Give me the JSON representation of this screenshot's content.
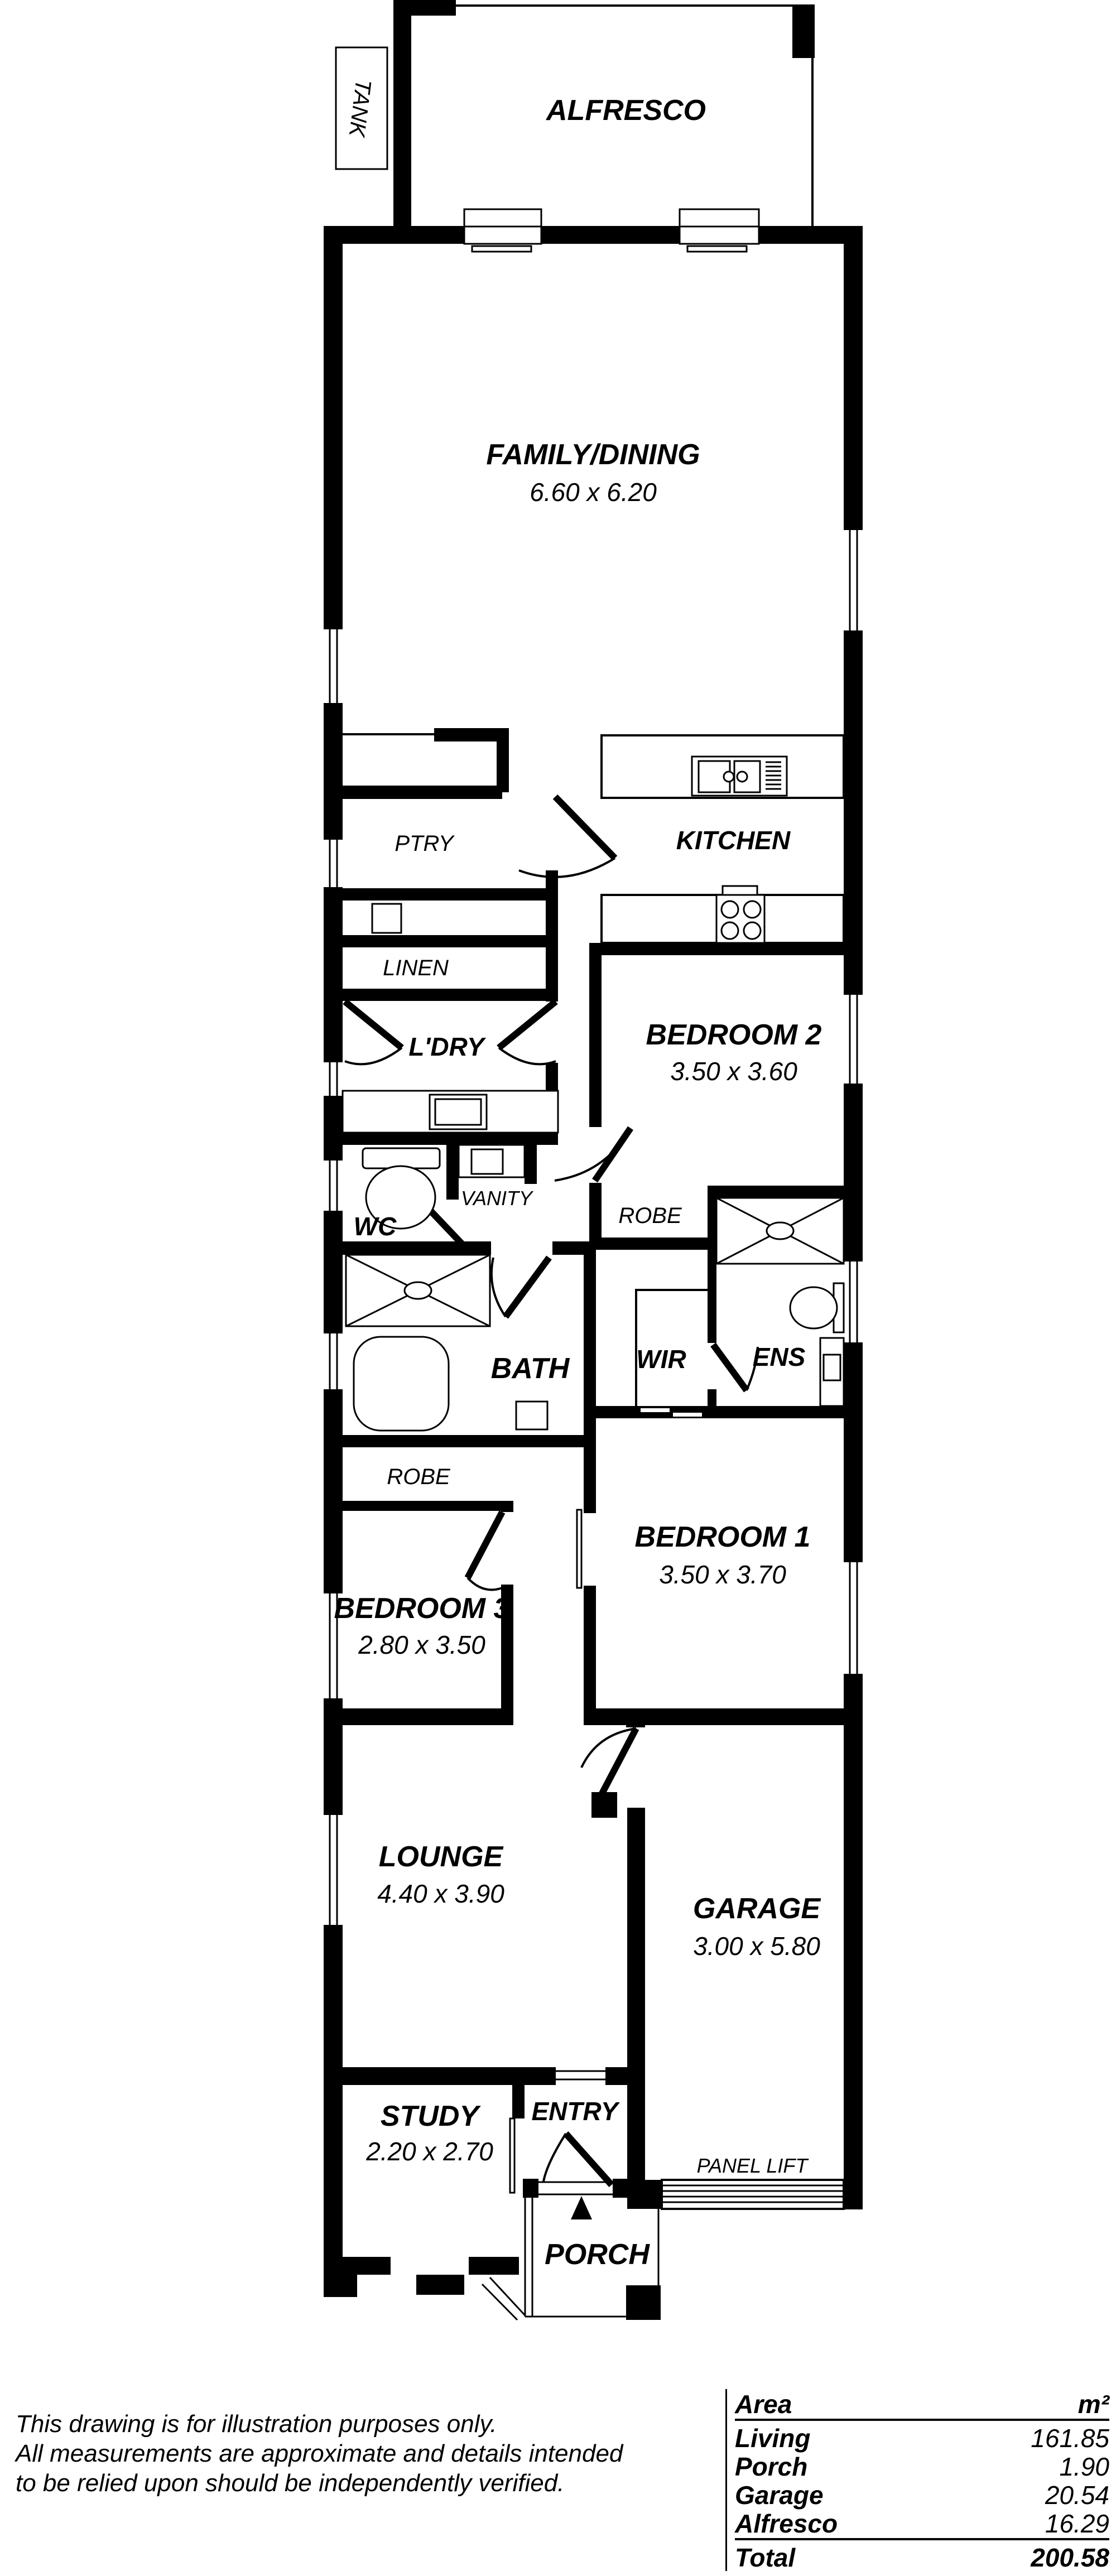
{
  "colors": {
    "wall": "#000000",
    "background": "#ffffff"
  },
  "plan": {
    "rooms": {
      "alfresco": {
        "name": "ALFRESCO"
      },
      "family": {
        "name": "FAMILY/DINING",
        "dims": "6.60 x 6.20"
      },
      "kitchen": {
        "name": "KITCHEN"
      },
      "ptry": {
        "name": "PTRY"
      },
      "linen": {
        "name": "LINEN"
      },
      "ldry": {
        "name": "L'DRY"
      },
      "wc": {
        "name": "WC"
      },
      "vanity": {
        "name": "VANITY"
      },
      "bath": {
        "name": "BATH"
      },
      "robe_bed2": {
        "name": "ROBE"
      },
      "robe_bed3": {
        "name": "ROBE"
      },
      "wir": {
        "name": "WIR"
      },
      "ens": {
        "name": "ENS"
      },
      "bedroom2": {
        "name": "BEDROOM 2",
        "dims": "3.50 x 3.60"
      },
      "bedroom1": {
        "name": "BEDROOM 1",
        "dims": "3.50 x 3.70"
      },
      "bedroom3": {
        "name": "BEDROOM 3",
        "dims": "2.80 x 3.50"
      },
      "lounge": {
        "name": "LOUNGE",
        "dims": "4.40 x 3.90"
      },
      "garage": {
        "name": "GARAGE",
        "dims": "3.00 x 5.80"
      },
      "study": {
        "name": "STUDY",
        "dims": "2.20 x 2.70"
      },
      "entry": {
        "name": "ENTRY"
      },
      "porch": {
        "name": "PORCH"
      }
    },
    "annotations": {
      "tank": "TANK",
      "panel_lift": "PANEL LIFT"
    }
  },
  "disclaimer": {
    "line1": "This drawing is for illustration purposes only.",
    "line2": "All measurements are approximate and details intended",
    "line3": "to be relied upon should be independently verified."
  },
  "area_table": {
    "header": {
      "label": "Area",
      "unit": "m²"
    },
    "rows": [
      {
        "label": "Living",
        "value": "161.85"
      },
      {
        "label": "Porch",
        "value": "1.90"
      },
      {
        "label": "Garage",
        "value": "20.54"
      },
      {
        "label": "Alfresco",
        "value": "16.29"
      }
    ],
    "total": {
      "label": "Total",
      "value": "200.58"
    }
  }
}
